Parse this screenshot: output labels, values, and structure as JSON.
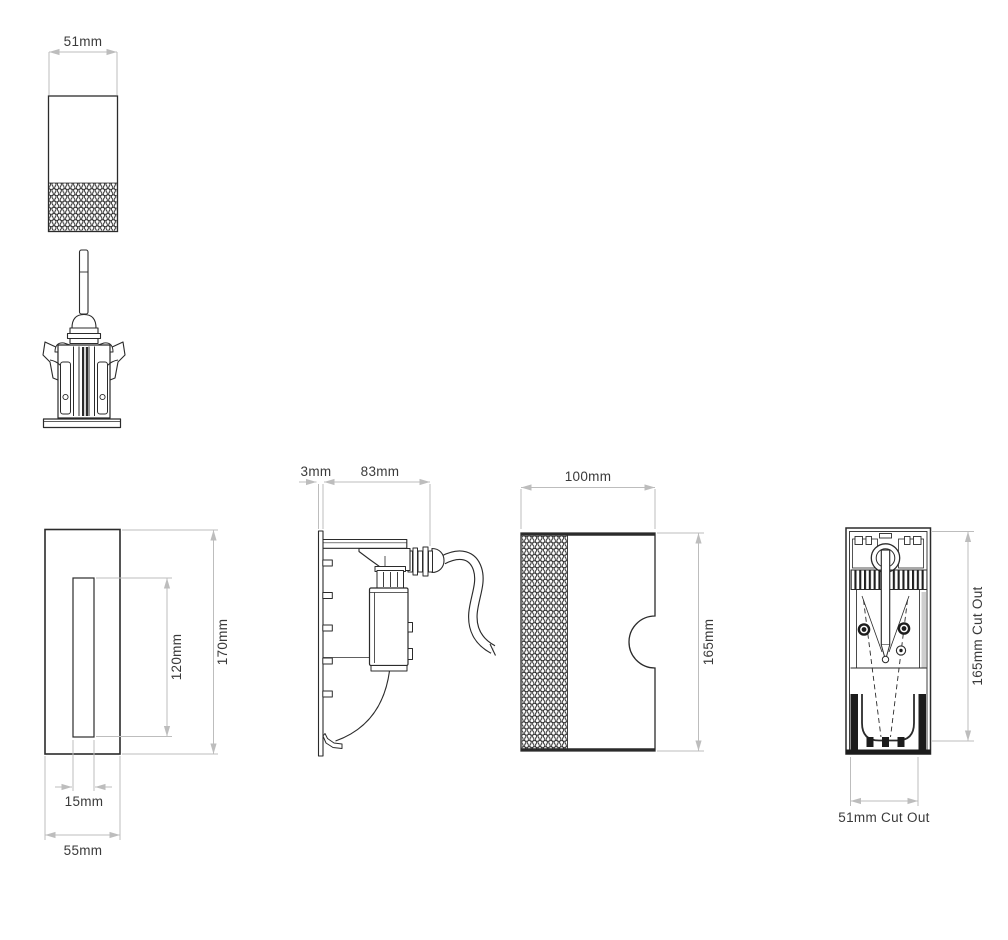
{
  "views": {
    "top_elevation": {
      "width_label": "51mm"
    },
    "front_elevation": {
      "overall_height_label": "170mm",
      "aperture_height_label": "120mm",
      "aperture_width_label": "15mm",
      "overall_width_label": "55mm"
    },
    "side_elevation": {
      "faceplate_thickness_label": "3mm",
      "recess_depth_label": "83mm"
    },
    "body_elevation": {
      "width_label": "100mm",
      "height_label": "165mm"
    },
    "rear_view": {
      "cutout_height_label": "165mm Cut Out",
      "cutout_width_label": "51mm Cut Out"
    }
  },
  "colors": {
    "background": "#ffffff",
    "outline": "#2b2b2b",
    "dimension_line": "#bdbdbd",
    "label_text": "#3a3a3a"
  }
}
